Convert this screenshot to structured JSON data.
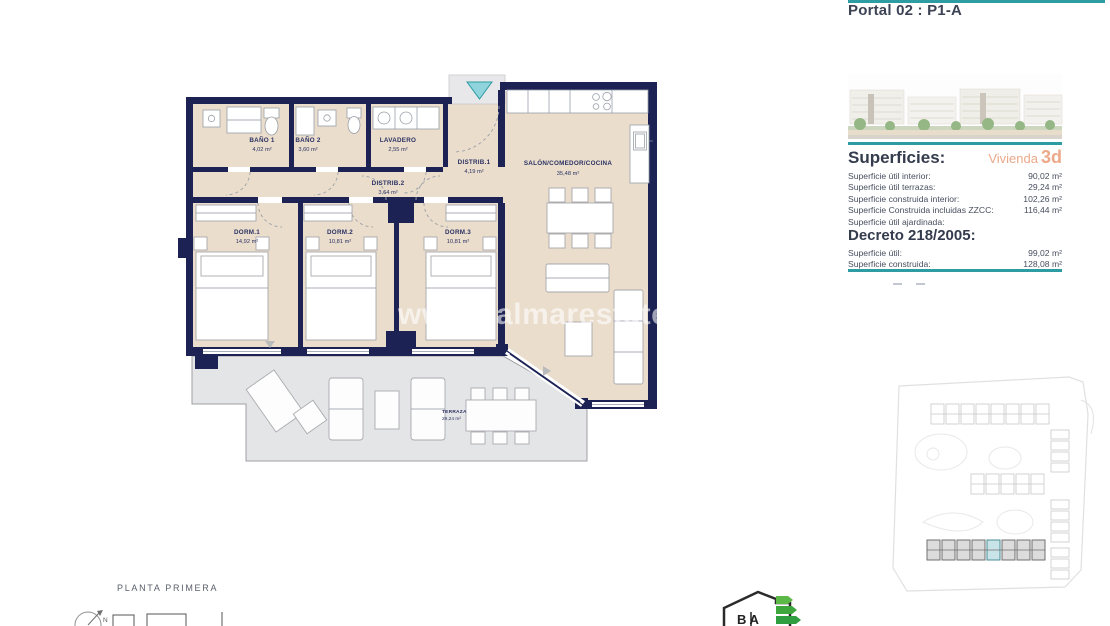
{
  "header": {
    "title": "Portal 02 : P1-A"
  },
  "watermark": "www.palmarestate.com",
  "plan_caption": "PLANTA PRIMERA",
  "compass_label": "N",
  "energy_logo_text": "B A",
  "accent_colors": {
    "teal": "#2E9CA3",
    "orange": "#ECA98A",
    "navy": "#1C2254",
    "floor_beige": "#EADDCC",
    "terrace_grey": "#E4E5E7"
  },
  "rooms": {
    "banio1": {
      "name": "BAÑO 1",
      "area": "4,02 m²"
    },
    "banio2": {
      "name": "BAÑO 2",
      "area": "3,60 m²"
    },
    "lavadero": {
      "name": "LAVADERO",
      "area": "2,55 m²"
    },
    "distrib1": {
      "name": "DISTRIB.1",
      "area": "4,19 m²"
    },
    "distrib2": {
      "name": "DISTRIB.2",
      "area": "3,64 m²"
    },
    "salon": {
      "name": "SALÓN/COMEDOR/COCINA",
      "area": "35,48 m²"
    },
    "dorm1": {
      "name": "DORM.1",
      "area": "14,92 m²"
    },
    "dorm2": {
      "name": "DORM.2",
      "area": "10,81 m²"
    },
    "dorm3": {
      "name": "DORM.3",
      "area": "10,81 m²"
    },
    "terraza": {
      "name": "TERRAZA",
      "area": "29,24 m²"
    }
  },
  "superficies": {
    "heading": "Superficies:",
    "vivienda_label": "Vivienda",
    "vivienda_number": "3d",
    "rows": [
      {
        "label": "Superficie útil interior:",
        "value": "90,02 m²"
      },
      {
        "label": "Superficie útil terrazas:",
        "value": "29,24 m²"
      },
      {
        "label": "Superficie construida interior:",
        "value": "102,26 m²"
      },
      {
        "label": "Superficie Construida incluidas ZZCC:",
        "value": "116,44 m²"
      },
      {
        "label": "Superficie útil ajardinada:",
        "value": ""
      }
    ],
    "decreto_heading": "Decreto 218/2005:",
    "decreto_rows": [
      {
        "label": "Superficie útil:",
        "value": "99,02 m²"
      },
      {
        "label": "Superficie construida:",
        "value": "128,08 m²"
      }
    ]
  }
}
